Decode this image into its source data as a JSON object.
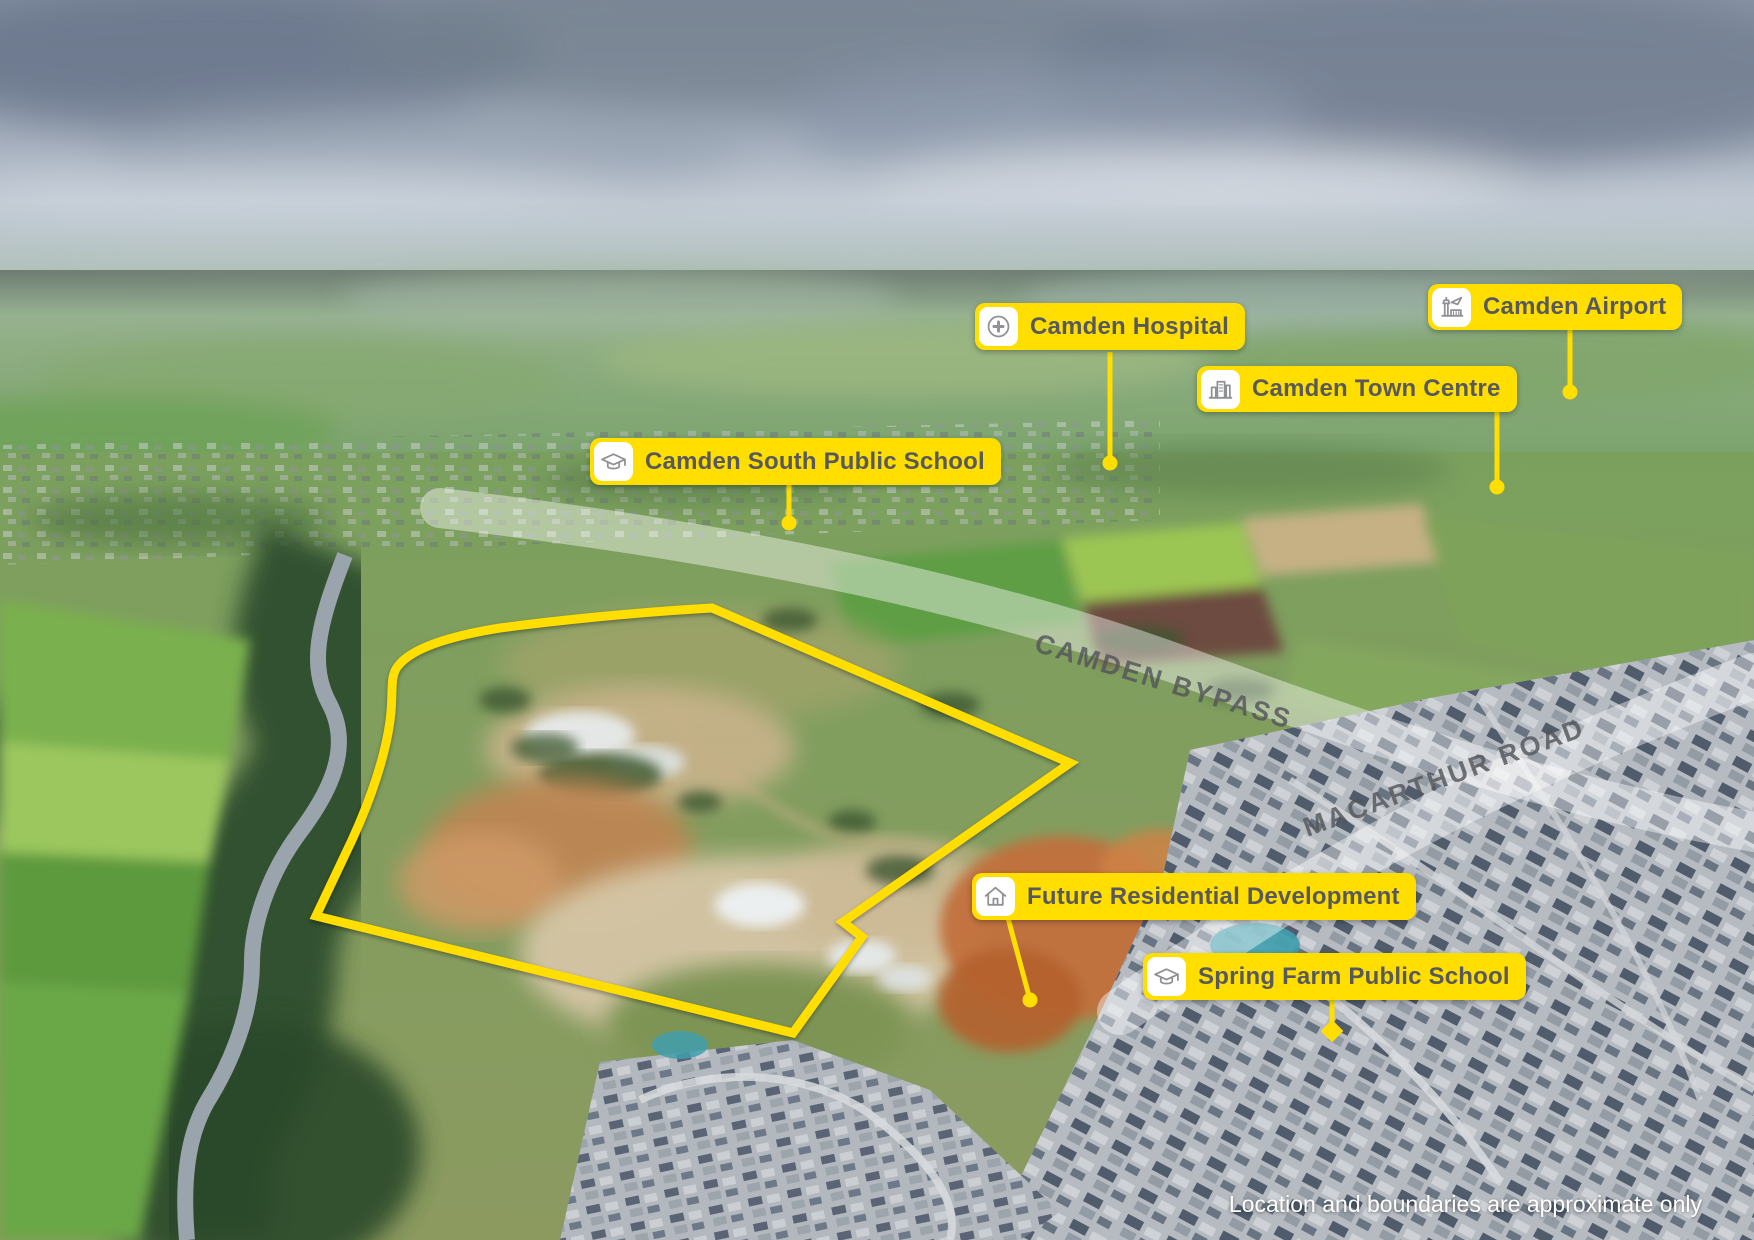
{
  "labels": [
    {
      "id": "camden-hospital",
      "text": "Camden Hospital",
      "icon": "hospital-cross-icon"
    },
    {
      "id": "camden-town-centre",
      "text": "Camden Town Centre",
      "icon": "town-buildings-icon"
    },
    {
      "id": "camden-airport",
      "text": "Camden Airport",
      "icon": "airport-icon"
    },
    {
      "id": "camden-south-public-school",
      "text": "Camden South Public School",
      "icon": "graduation-cap-icon"
    },
    {
      "id": "future-residential-development",
      "text": "Future Residential Development",
      "icon": "house-icon"
    },
    {
      "id": "spring-farm-public-school",
      "text": "Spring Farm Public School",
      "icon": "graduation-cap-icon"
    }
  ],
  "roads": [
    {
      "name": "CAMDEN BYPASS"
    },
    {
      "name": "MACARTHUR ROAD"
    }
  ],
  "disclaimer": "Location and boundaries are approximate only",
  "colors": {
    "label_bg": "#FFDE00",
    "label_text": "#58595B",
    "boundary": "#FFDE00",
    "road_band": "rgba(255,255,255,0.45)",
    "road_text": "#54565A",
    "icon_stroke": "#8F9194"
  }
}
